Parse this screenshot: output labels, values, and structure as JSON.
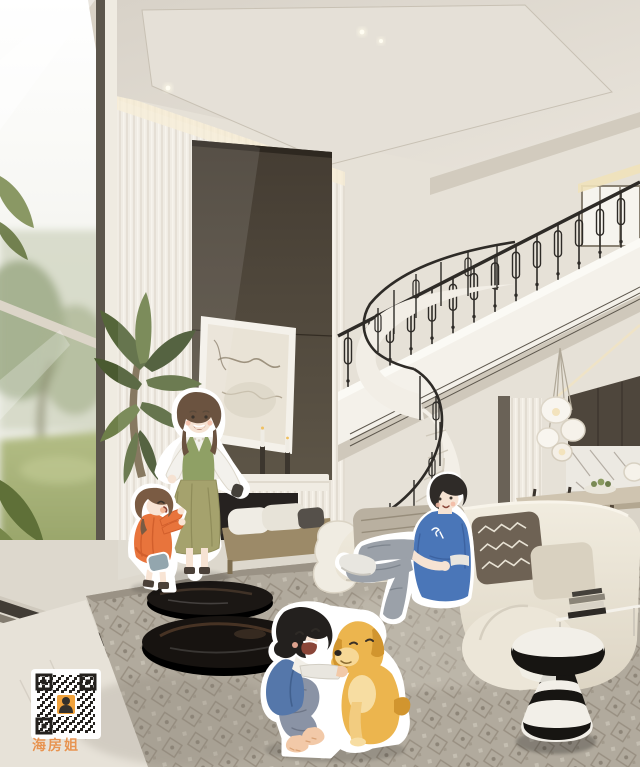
{
  "meta": {
    "title": "Duplex living room rendering with cartoon family stickers",
    "width": 640,
    "height": 767
  },
  "watermark": {
    "text": "海房姐",
    "qr_label": "wechat-qr-code",
    "qr_center": "person-avatar"
  },
  "palette": {
    "ceiling": "#ded8cf",
    "wall": "#f0ece3",
    "dark_panel": "#4a4238",
    "railing": "#2e2b27",
    "stair": "#f2eee6",
    "sofa": "#e9e3d5",
    "rug": "#b1aa9d",
    "marble_floor": "#e7e2d8",
    "lawn_green": "#9fae6a",
    "palm_green": "#55663a",
    "accent_orange": "#e8743c",
    "vest_green": "#8fa065",
    "skirt_olive": "#a5a26d",
    "tshirt_blue": "#4a76b8",
    "jacket_blue": "#5577aa",
    "pants_gray": "#9ba1a9",
    "dog_gold": "#ecb54e",
    "skin": "#f6e3d3",
    "watermark": "#e8873a",
    "qr_avatar_bg": "#f0a23c",
    "stool_black": "#171512",
    "stool_white": "#f2efe8"
  },
  "scene": {
    "description": "Double-height luxury living room: floor-to-ceiling windows with garden view at left, fluted cream wall with dark fireplace panel and abstract art, white spiral staircase with black wrought-iron loop balustrade, upper balcony, background dining area with petal pendant lamp, cream curved sofa, black oval coffee tables, patterned gray rug, black-and-white striped stool",
    "elements": [
      "ceiling-downlights",
      "garden-window",
      "indoor-palm",
      "artwork",
      "fireplace",
      "hearth-bench",
      "spiral-staircase",
      "balcony-railing",
      "pendant-lamp",
      "dining-set",
      "kitchen-backsplash",
      "sofa",
      "coffee-tables",
      "rug",
      "striped-stool",
      "book-stack"
    ]
  },
  "characters": [
    {
      "id": "mother",
      "label": "mother in green vest and olive skirt"
    },
    {
      "id": "daughter",
      "label": "little girl in orange dress"
    },
    {
      "id": "father",
      "label": "man in blue t-shirt sitting on sofa"
    },
    {
      "id": "son",
      "label": "boy laughing with dog"
    },
    {
      "id": "dog",
      "label": "golden retriever"
    }
  ]
}
